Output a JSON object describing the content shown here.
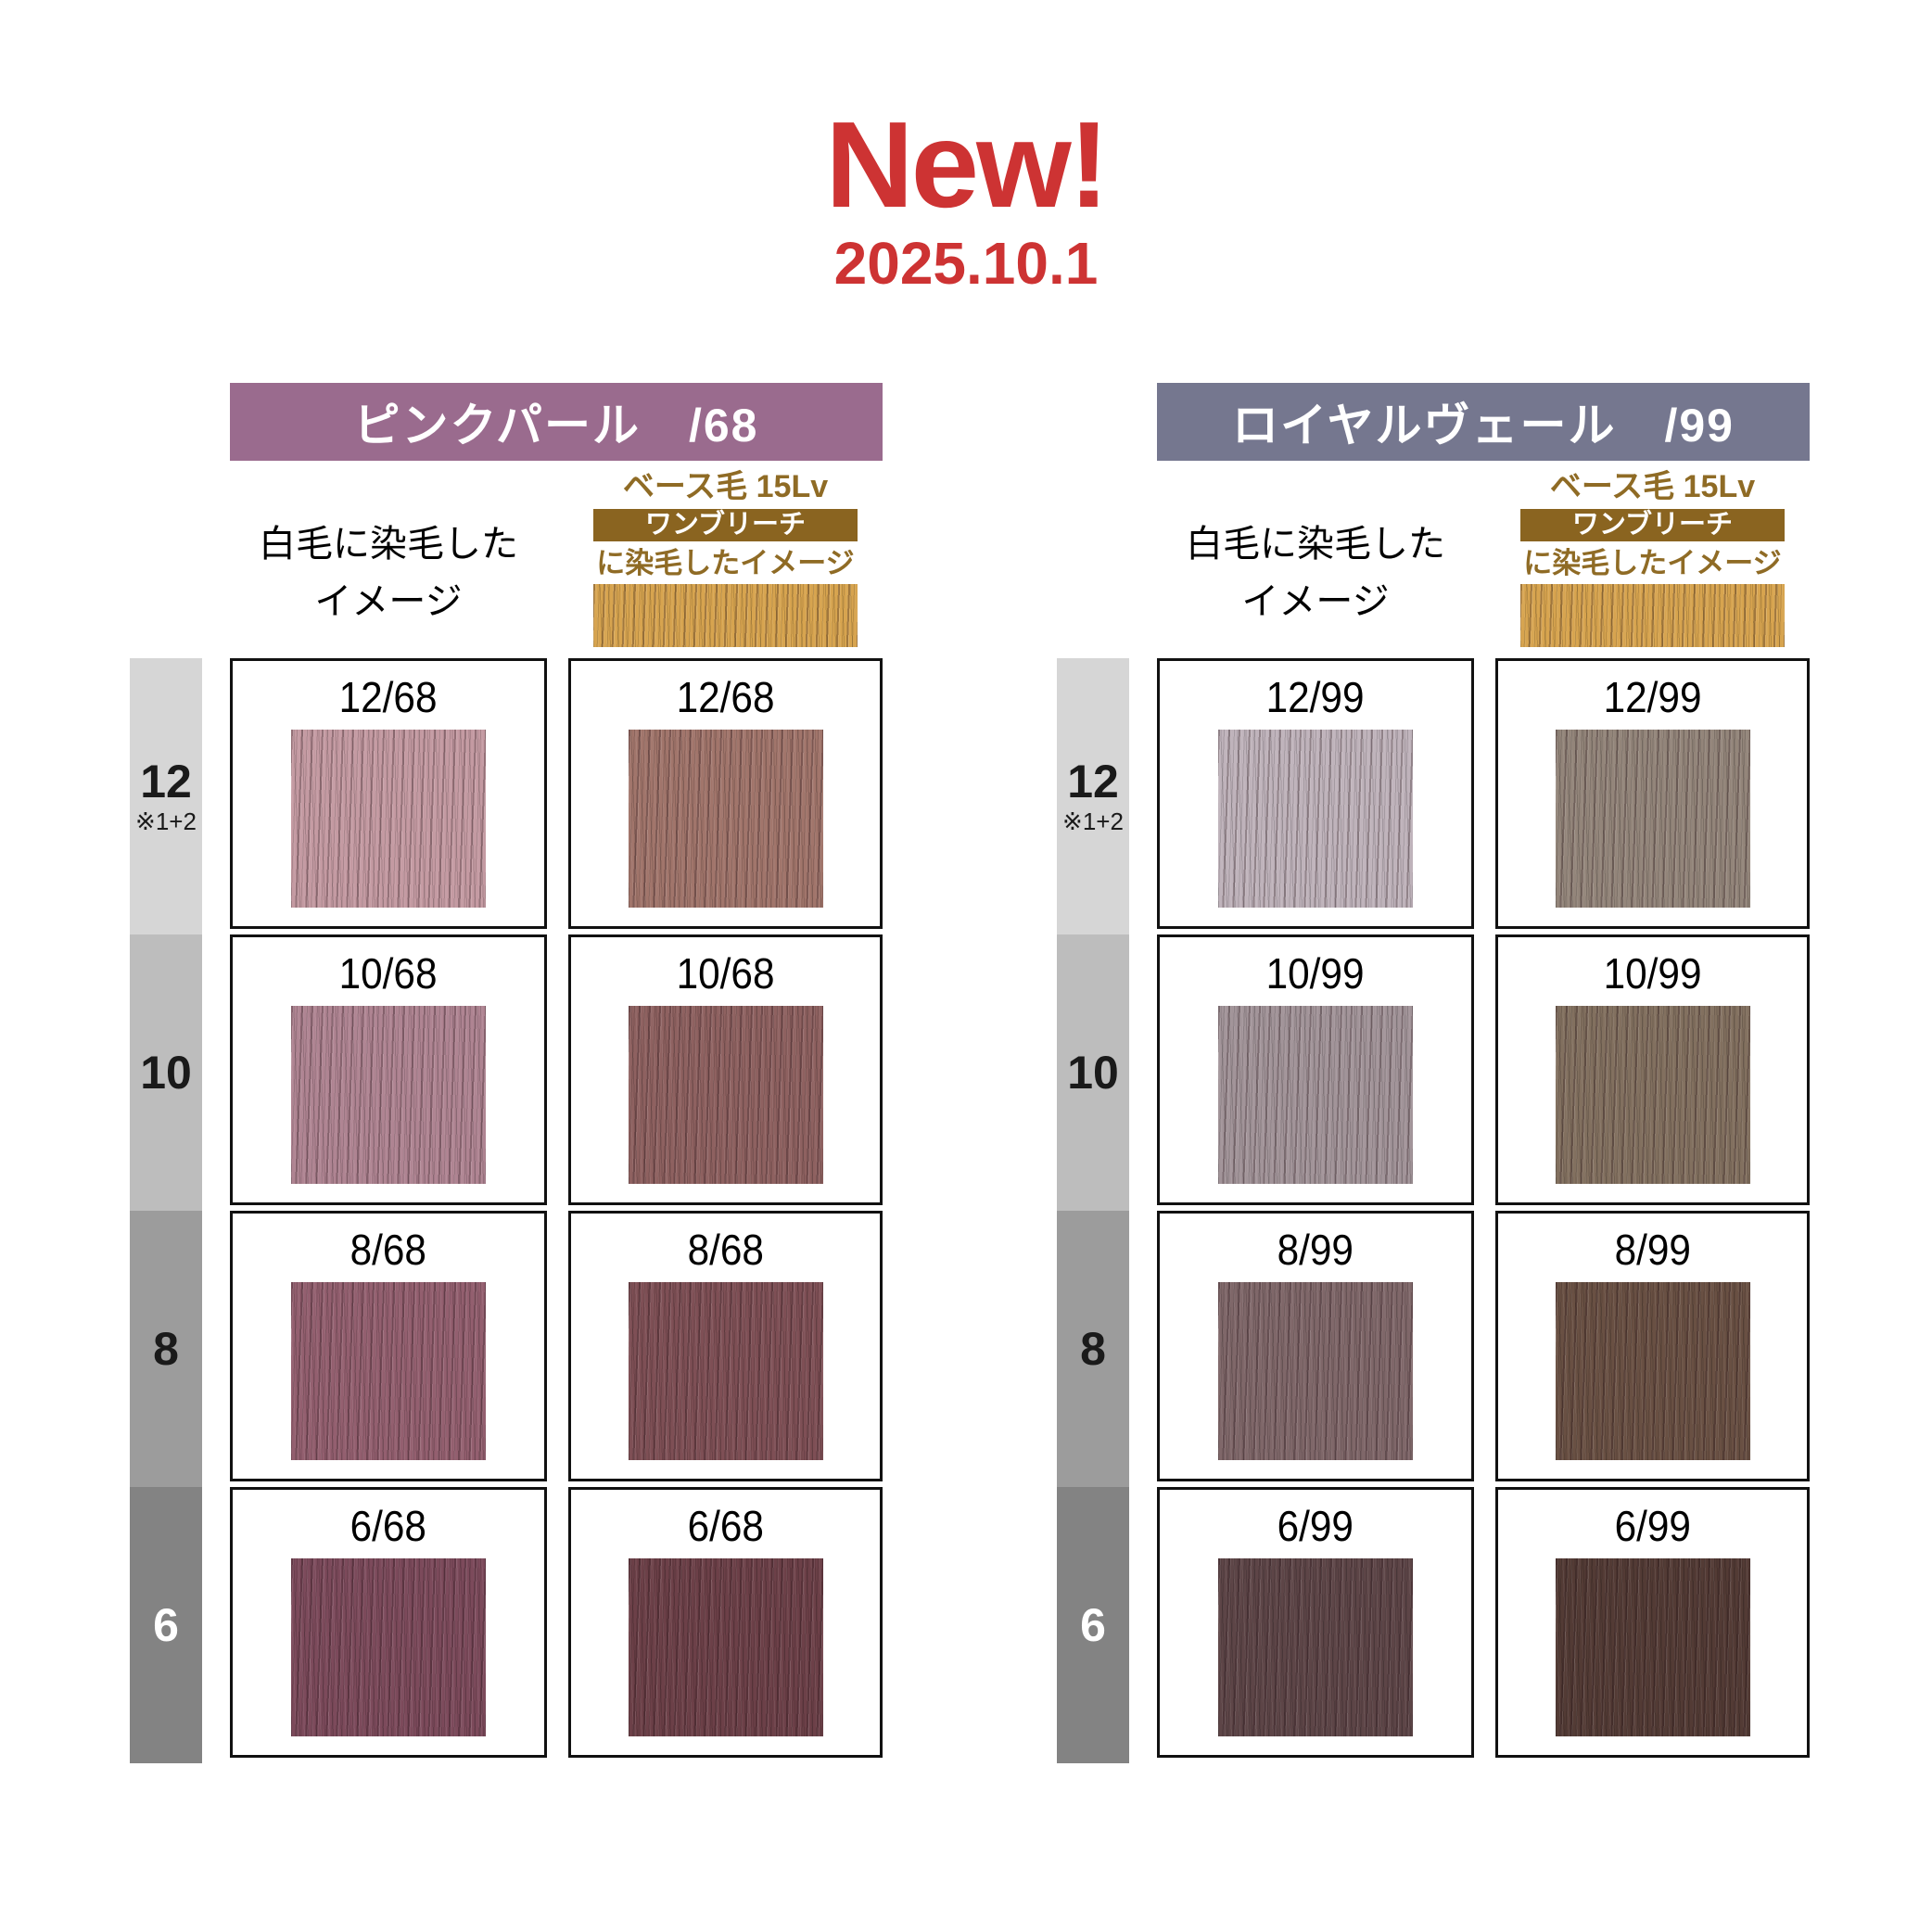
{
  "page": {
    "background": "#FFFFFF"
  },
  "header": {
    "title": "New!",
    "date": "2025.10.1",
    "accent_color": "#CD3333"
  },
  "white_hair_note": {
    "line1": "白毛に染毛した",
    "line2": "イメージ"
  },
  "base_hair": {
    "label_top": "ベース毛 15Lv",
    "band_label": "ワンブリーチ",
    "label_bottom": "に染毛したイメージ",
    "text_color": "#8F6B25",
    "band_bg": "#8A6420",
    "swatch_color": "#D7A44F"
  },
  "levels": [
    {
      "value": "12",
      "note": "※1+2",
      "bg": "#D6D6D6",
      "fg": "#1A1A1A"
    },
    {
      "value": "10",
      "bg": "#BDBDBD",
      "fg": "#1A1A1A"
    },
    {
      "value": "8",
      "bg": "#9C9C9C",
      "fg": "#1A1A1A"
    },
    {
      "value": "6",
      "bg": "#838383",
      "fg": "#FFFFFF"
    }
  ],
  "panels": [
    {
      "name": "pink-pearl",
      "title": "ピンクパール　/68",
      "title_bg": "#9A6B8E",
      "rows": [
        {
          "level": "12",
          "label": "12/68",
          "white": "#C49AA2",
          "bleach": "#A1756B"
        },
        {
          "level": "10",
          "label": "10/68",
          "white": "#AF8492",
          "bleach": "#8E6160"
        },
        {
          "level": "8",
          "label": "8/68",
          "white": "#935F6F",
          "bleach": "#7E4F55"
        },
        {
          "level": "6",
          "label": "6/68",
          "white": "#7C4A5B",
          "bleach": "#6C4048"
        }
      ]
    },
    {
      "name": "royal-veil",
      "title": "ロイヤルヴェール　/99",
      "title_bg": "#75778F",
      "rows": [
        {
          "level": "12",
          "label": "12/99",
          "white": "#BFB3BB",
          "bleach": "#93857A"
        },
        {
          "level": "10",
          "label": "10/99",
          "white": "#A29499",
          "bleach": "#82705F"
        },
        {
          "level": "8",
          "label": "8/99",
          "white": "#7F6769",
          "bleach": "#695043"
        },
        {
          "level": "6",
          "label": "6/99",
          "white": "#5D4547",
          "bleach": "#533B35"
        }
      ]
    }
  ]
}
